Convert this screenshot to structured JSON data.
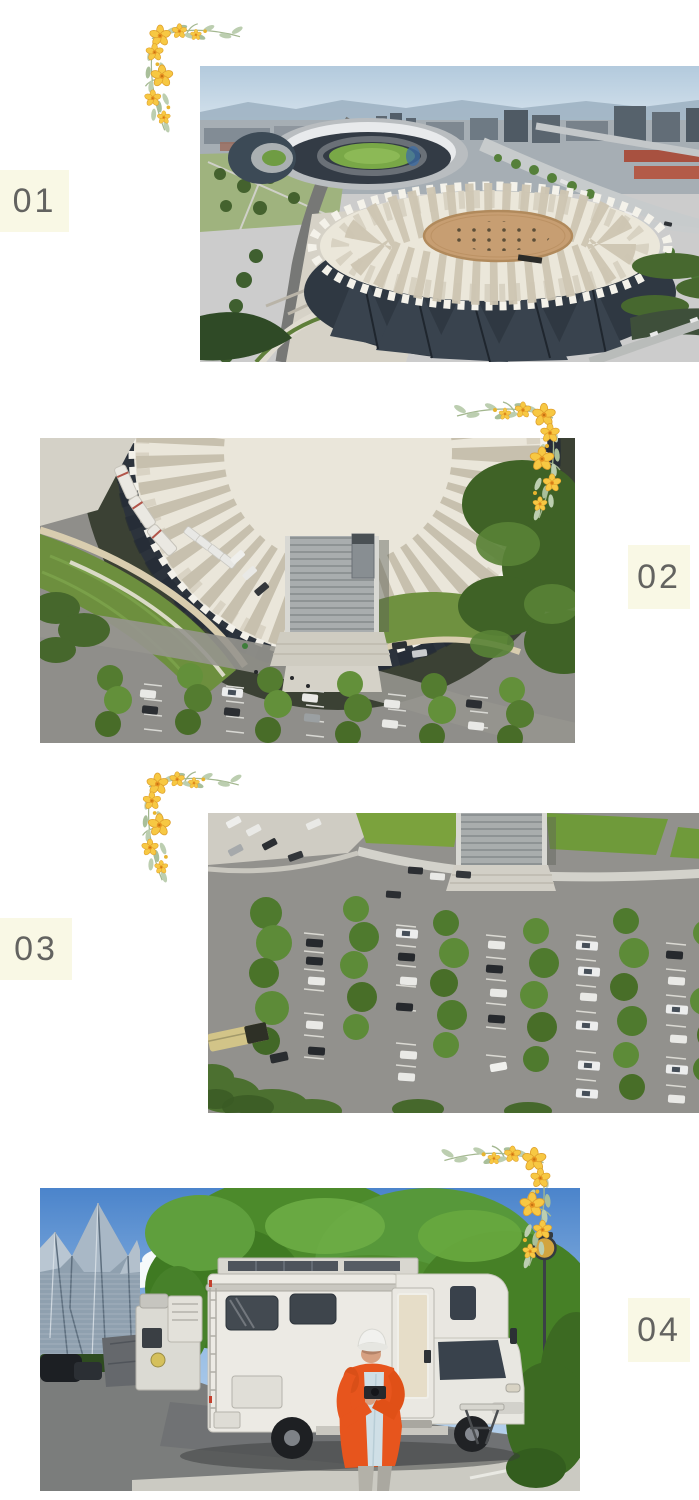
{
  "page": {
    "background": "#ffffff"
  },
  "badges": [
    {
      "number": "01"
    },
    {
      "number": "02"
    },
    {
      "number": "03"
    },
    {
      "number": "04"
    }
  ],
  "photos": [
    {
      "name": "aerial-stadium-and-arena",
      "description": "Drone view of a city sports park: oval stadium with green field and a round arena with white folded fan roof and tan circular center"
    },
    {
      "name": "aerial-arena-top-down",
      "description": "Top-down drone view of the round pleated-roof arena, curved lawns, louvered entrance stair and tree-lined parking rows"
    },
    {
      "name": "aerial-parking-lot",
      "description": "Top-down drone view of a large parking lot with rows of trees, cars, white campervans and a pale yellow bus"
    },
    {
      "name": "rv-campsite",
      "description": "Person in an orange coat and white cap standing beside a white motorhome parked under trees near the faceted arena"
    }
  ],
  "style": {
    "badge_background": "#f9f8e5",
    "badge_text_color": "#636360",
    "flower_petal": "#f7c843",
    "flower_center": "#e89322",
    "leaf_color": "#bcceb0"
  }
}
